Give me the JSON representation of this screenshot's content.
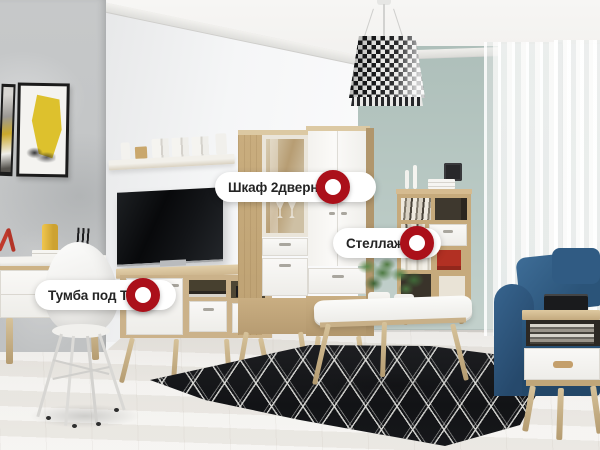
{
  "page": {
    "type": "interactive-furniture-showcase"
  },
  "hotspots": [
    {
      "id": "wardrobe",
      "label": "Шкаф 2дверный"
    },
    {
      "id": "shelving",
      "label": "Стеллаж"
    },
    {
      "id": "tv_stand",
      "label": "Тумба под ТВ"
    }
  ],
  "marker_icon": {
    "name": "red-ring-marker",
    "shape": "donut",
    "color": "#ab101a",
    "hole_color": "#ffffff"
  },
  "label_style": {
    "bg": "#ffffff",
    "text_color": "#242424"
  },
  "scene_colors": {
    "wall_left_gray": "#c4c6c7",
    "wall_center_white": "#f3f4f5",
    "wall_right_sage": "#b7c7c2",
    "ceiling_white": "#f6f5f3",
    "floor_wood_white": "#e9e7e3",
    "oak_wood": "#cdb58d",
    "furniture_white": "#f6f5f2",
    "tv_black": "#0d0e10",
    "sofa_blue": "#2e5a80",
    "rug_black": "#17181a",
    "rug_pattern_white": "#d9d9d6",
    "accent_yellow": "#ddc12d",
    "plant_green": "#4d7a42",
    "decor_red": "#b23023"
  }
}
